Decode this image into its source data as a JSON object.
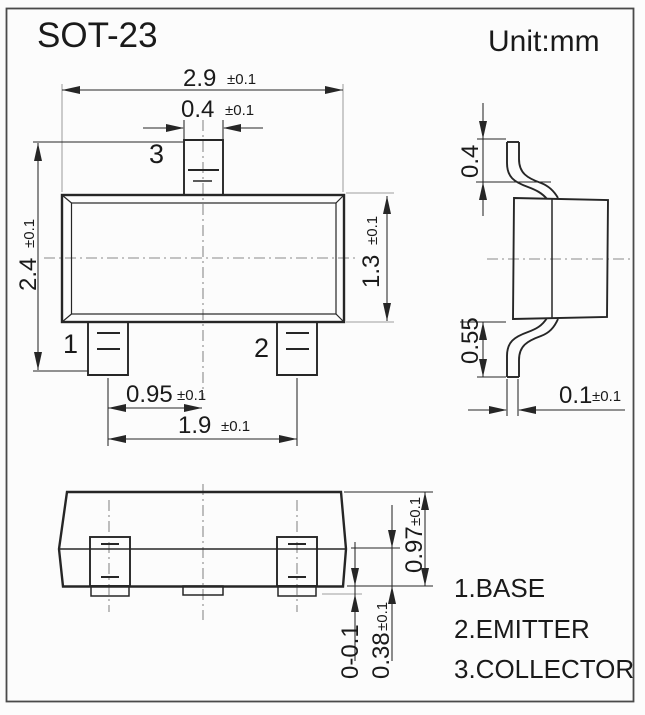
{
  "page": {
    "title": "SOT-23",
    "unit": "Unit:mm"
  },
  "front": {
    "pin1": "1",
    "pin2": "2",
    "pin3": "3",
    "dims": {
      "body_width": {
        "value": "2.9",
        "tol": "±0.1"
      },
      "lead_width": {
        "value": "0.4",
        "tol": "±0.1"
      },
      "overall_height": {
        "value": "2.4",
        "tol": "±0.1"
      },
      "body_height": {
        "value": "1.3",
        "tol": "±0.1"
      },
      "lead_pitch": {
        "value": "0.95",
        "tol": "±0.1"
      },
      "lead_span": {
        "value": "1.9",
        "tol": "±0.1"
      }
    }
  },
  "side": {
    "dims": {
      "upper_lead": {
        "value": "0.4",
        "tol": ""
      },
      "lower_lead": {
        "value": "0.55",
        "tol": ""
      },
      "lead_thickness": {
        "value": "0.1",
        "tol": "±0.1"
      }
    }
  },
  "bottom": {
    "dims": {
      "height": {
        "value": "0.97",
        "tol": "±0.1"
      },
      "standoff": {
        "value": "0-0.1",
        "tol": ""
      },
      "edge_height": {
        "value": "0.38",
        "tol": "±0.1"
      }
    }
  },
  "legend": {
    "items": [
      "1.BASE",
      "2.EMITTER",
      "3.COLLECTOR"
    ]
  },
  "colors": {
    "line": "#262626",
    "extension_line": "#9e9e9e",
    "centerline": "#8a8a8a",
    "text": "#1a1a1a",
    "border": "#4a4a4a",
    "background": "#fcfcfc"
  }
}
